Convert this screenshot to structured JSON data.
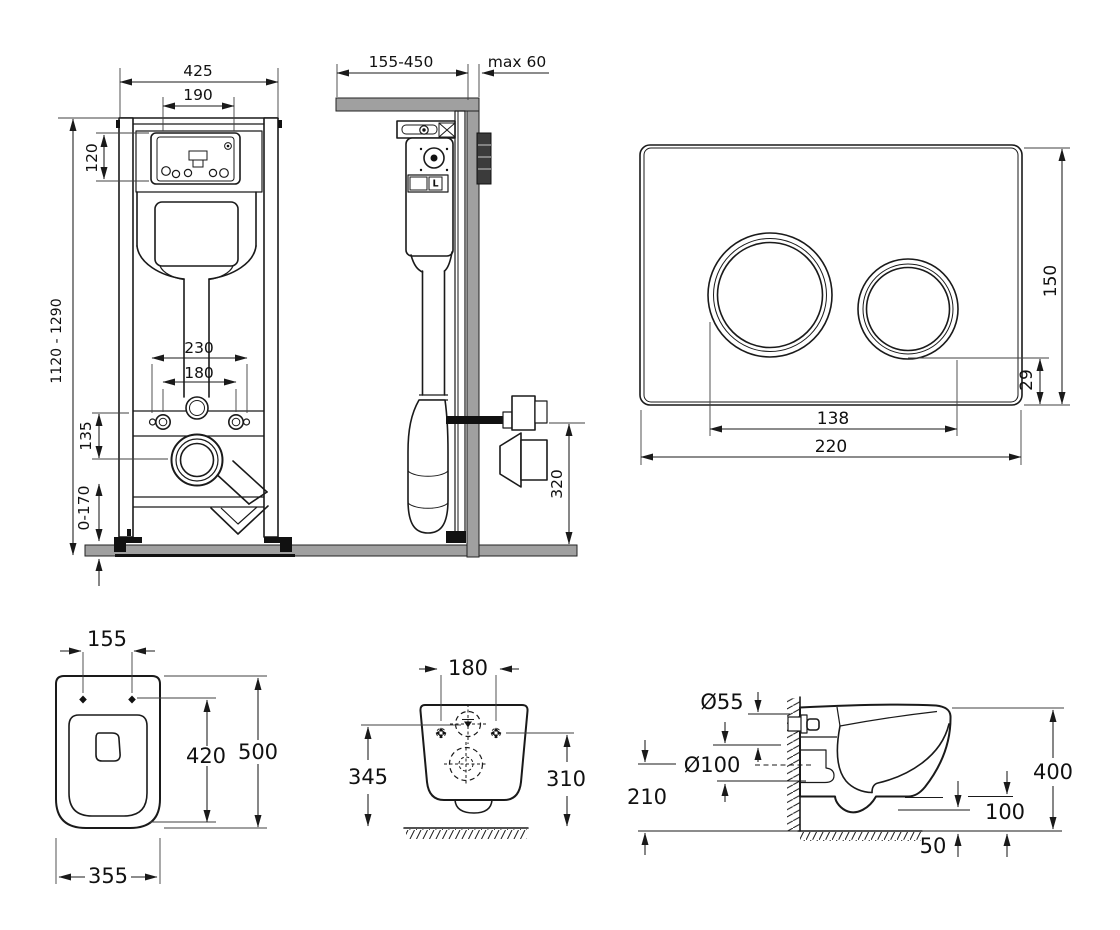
{
  "views": {
    "frame_front": {
      "dims": {
        "frame_width": "425",
        "opening_width": "190",
        "opening_height": "120",
        "height_range": "1120 - 1290",
        "fixing_span_outer": "230",
        "fixing_span_inner": "180",
        "inlet_offset": "135",
        "foot_range": "0-170"
      }
    },
    "frame_side": {
      "dims": {
        "rail_depth_range": "155-450",
        "max_finish": "max 60",
        "outlet_height": "320"
      },
      "labels": {
        "cistern_marker": "L"
      }
    },
    "flush_plate": {
      "dims": {
        "height": "150",
        "button_offset": "29",
        "button_span": "138",
        "width": "220"
      }
    },
    "bowl_top": {
      "dims": {
        "fixing_span": "155",
        "depth_inner": "420",
        "depth": "500",
        "width": "355"
      }
    },
    "bowl_rear": {
      "dims": {
        "fixing_span": "180",
        "height_left": "345",
        "height_right": "310"
      }
    },
    "bowl_side": {
      "dims": {
        "inlet_diameter": "Ø55",
        "outlet_diameter": "Ø100",
        "outlet_axis_height": "210",
        "height": "400",
        "rim_clearance": "100",
        "floor_gap": "50"
      }
    }
  },
  "colors": {
    "line": "#1a1a1a",
    "masonry": "#a0a0a0",
    "recess_box": "#3b3b3b"
  }
}
